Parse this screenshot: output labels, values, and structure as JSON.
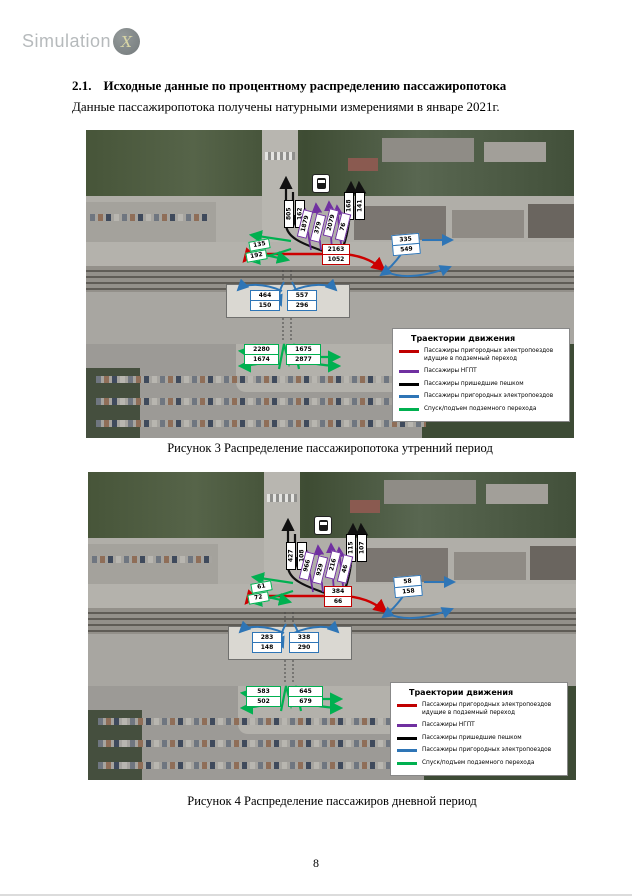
{
  "logo": {
    "name": "Simulation",
    "x_letter": "X"
  },
  "section": {
    "number": "2.1.",
    "heading": "Исходные данные по процентному распределению пассажиропотока"
  },
  "intro_text": "Данные пассажиропотока получены натурными измерениями в январе 2021г.",
  "page_number": "8",
  "legend": {
    "title": "Траектории движения",
    "items": [
      {
        "label": "Пассажиры пригородных электропоездов идущие в подземный переход",
        "color": "#C00000"
      },
      {
        "label": "Пассажиры НГПТ",
        "color": "#7030A0"
      },
      {
        "label": "Пассажиры пришедшие пешком",
        "color": "#000000"
      },
      {
        "label": "Пассажиры пригородных электропоездов",
        "color": "#2E75B6"
      },
      {
        "label": "Спуск/подъем подземного перехода",
        "color": "#00B050"
      }
    ]
  },
  "figures": [
    {
      "caption": "Рисунок 3 Распределение пассажиропотока утренний период",
      "flows": {
        "pedestrian_left": [
          "805",
          "162"
        ],
        "pedestrian_right": [
          "168",
          "141"
        ],
        "ngpt": [
          "1879",
          "379",
          "2079",
          "76"
        ],
        "to_underpass": [
          "2163",
          "1052"
        ],
        "exit_west": [
          "135",
          "192"
        ],
        "exit_east": [
          "335",
          "549"
        ],
        "platform_west": [
          "464",
          "150"
        ],
        "platform_east": [
          "557",
          "296"
        ],
        "underpass_west": [
          "2280",
          "1674"
        ],
        "underpass_east": [
          "1675",
          "2877"
        ]
      }
    },
    {
      "caption": "Рисунок 4 Распределение пассажиров дневной период",
      "flows": {
        "pedestrian_left": [
          "427",
          "108"
        ],
        "pedestrian_right": [
          "115",
          "107"
        ],
        "ngpt": [
          "966",
          "929",
          "216",
          "46"
        ],
        "to_underpass": [
          "384",
          "66"
        ],
        "exit_west": [
          "61",
          "72"
        ],
        "exit_east": [
          "58",
          "158"
        ],
        "platform_west": [
          "283",
          "148"
        ],
        "platform_east": [
          "338",
          "290"
        ],
        "underpass_west": [
          "583",
          "502"
        ],
        "underpass_east": [
          "645",
          "679"
        ]
      }
    }
  ]
}
